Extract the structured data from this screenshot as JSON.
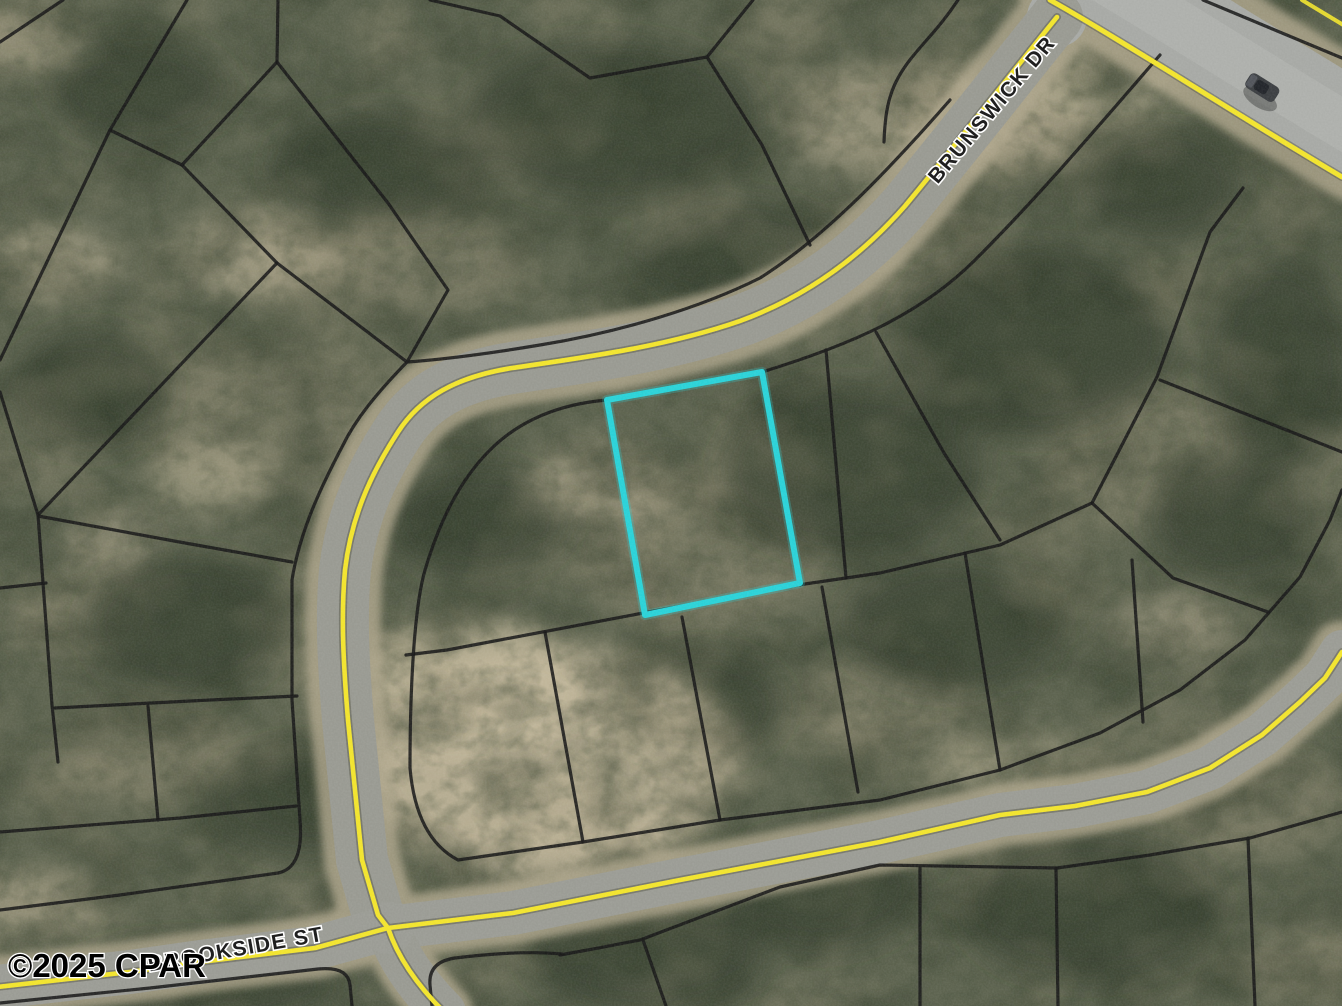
{
  "map": {
    "type": "aerial-parcel-map",
    "watermark": {
      "text": "©2025 CPAR"
    },
    "street_labels": [
      {
        "id": "brunswick-dr",
        "text": "BRUNSWICK DR"
      },
      {
        "id": "brookside-st",
        "text": "BROOKSIDE ST"
      }
    ],
    "highlighted_parcel": {
      "outline_color": "#2bd2d8"
    },
    "colors": {
      "road_centerline": "#f2e42e",
      "parcel_boundary": "#1a1a1a",
      "pavement": "#9b9c95",
      "vegetation": "#5e6450"
    },
    "objects": [
      {
        "name": "vehicle"
      }
    ]
  }
}
